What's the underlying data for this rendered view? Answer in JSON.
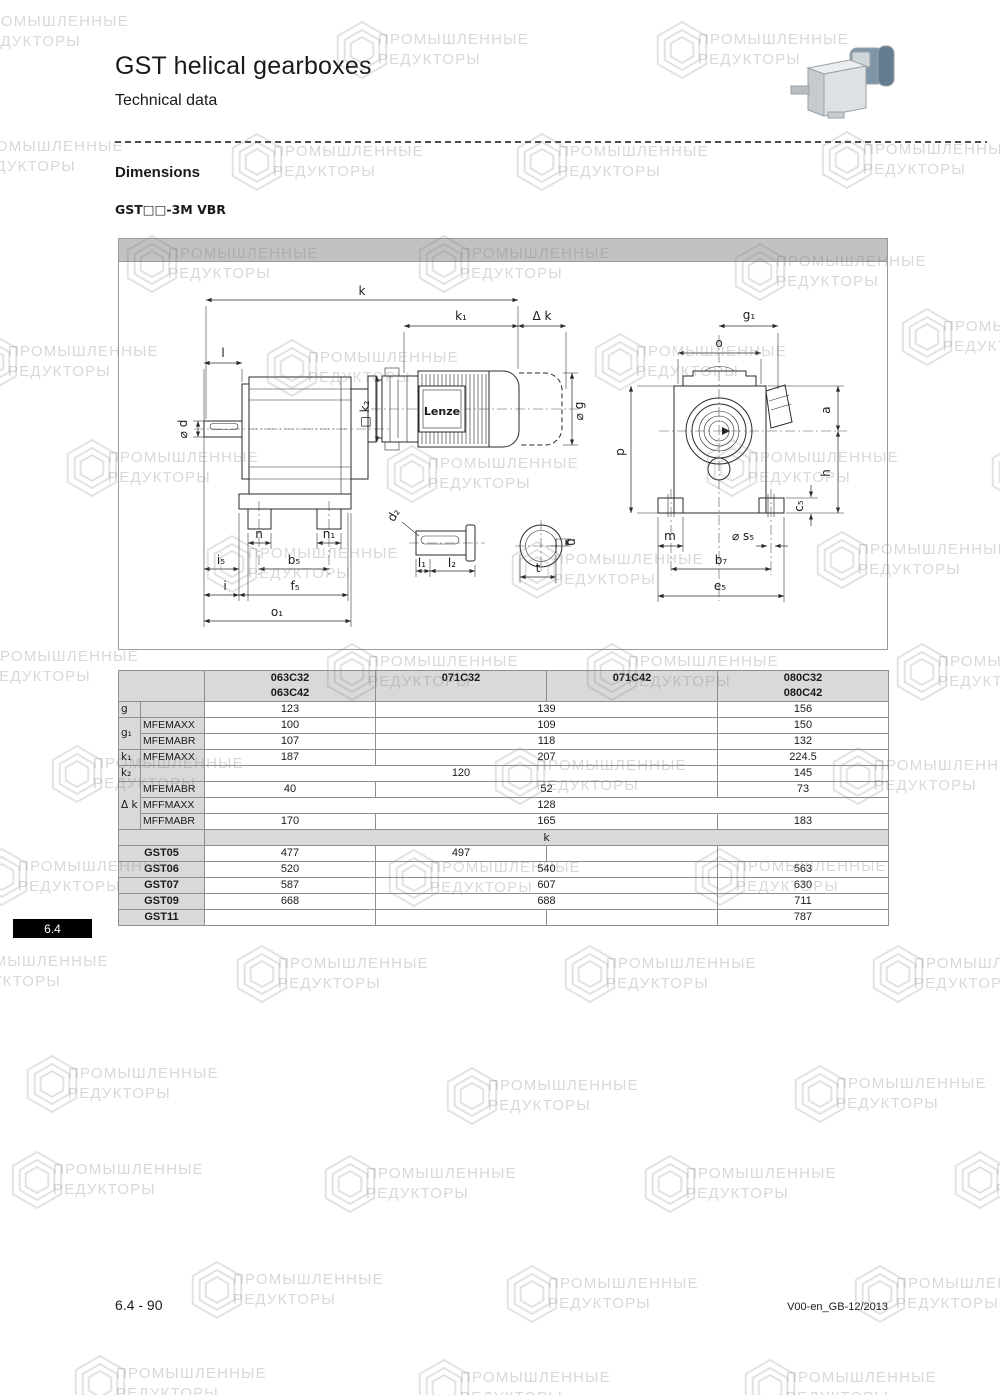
{
  "header": {
    "title": "GST helical gearboxes",
    "subtitle": "Technical data"
  },
  "section": {
    "heading": "Dimensions",
    "variant": "GST□□-3M VBR"
  },
  "footer": {
    "page": "6.4 - 90",
    "doc_code": "V00-en_GB-12/2013",
    "side_tab": "6.4"
  },
  "colors": {
    "table_header_bg": "#d9d9d9",
    "drawing_bar_bg": "#c2c2c2",
    "table_border": "#8f8f8f",
    "tab_bg": "#000000",
    "motor_blue": "#7f96a9"
  },
  "watermark": {
    "line1": "ПРОМЫШЛЕННЫЕ",
    "line2": "РЕДУКТОРЫ",
    "positions": [
      [
        -70,
        0
      ],
      [
        330,
        18
      ],
      [
        650,
        18
      ],
      [
        -75,
        125
      ],
      [
        225,
        130
      ],
      [
        510,
        130
      ],
      [
        815,
        128
      ],
      [
        120,
        232
      ],
      [
        412,
        232
      ],
      [
        728,
        240
      ],
      [
        -40,
        330
      ],
      [
        260,
        336
      ],
      [
        588,
        330
      ],
      [
        895,
        305
      ],
      [
        60,
        436
      ],
      [
        380,
        442
      ],
      [
        700,
        436
      ],
      [
        985,
        440
      ],
      [
        200,
        532
      ],
      [
        505,
        538
      ],
      [
        810,
        528
      ],
      [
        -60,
        635
      ],
      [
        320,
        640
      ],
      [
        580,
        640
      ],
      [
        890,
        640
      ],
      [
        45,
        742
      ],
      [
        488,
        744
      ],
      [
        826,
        744
      ],
      [
        -30,
        845
      ],
      [
        382,
        846
      ],
      [
        688,
        845
      ],
      [
        -90,
        940
      ],
      [
        230,
        942
      ],
      [
        558,
        942
      ],
      [
        866,
        942
      ],
      [
        20,
        1052
      ],
      [
        440,
        1064
      ],
      [
        788,
        1062
      ],
      [
        5,
        1148
      ],
      [
        318,
        1152
      ],
      [
        638,
        1152
      ],
      [
        948,
        1148
      ],
      [
        185,
        1258
      ],
      [
        500,
        1262
      ],
      [
        848,
        1262
      ],
      [
        68,
        1352
      ],
      [
        412,
        1356
      ],
      [
        738,
        1356
      ],
      [
        1000,
        1350
      ]
    ]
  },
  "drawing": {
    "logo": "Lenze",
    "labels": [
      {
        "t": "k",
        "x": 243,
        "y": 56
      },
      {
        "t": "k₁",
        "x": 342,
        "y": 81
      },
      {
        "t": "Δ k",
        "x": 423,
        "y": 81
      },
      {
        "t": "l",
        "x": 104,
        "y": 118
      },
      {
        "t": "⌀ d",
        "x": 68,
        "y": 190,
        "r": -90
      },
      {
        "t": "□ k₂",
        "x": 250,
        "y": 175,
        "r": -90
      },
      {
        "t": "⌀ g",
        "x": 464,
        "y": 172,
        "r": -90
      },
      {
        "t": "Lenze",
        "x": 323,
        "y": 176,
        "cls": "logo"
      },
      {
        "t": "n",
        "x": 140,
        "y": 299
      },
      {
        "t": "n₁",
        "x": 210,
        "y": 299
      },
      {
        "t": "i₅",
        "x": 102,
        "y": 325
      },
      {
        "t": "b₅",
        "x": 175,
        "y": 325
      },
      {
        "t": "i",
        "x": 106,
        "y": 351
      },
      {
        "t": "f₅",
        "x": 176,
        "y": 351
      },
      {
        "t": "o₁",
        "x": 158,
        "y": 377
      },
      {
        "t": "d₂",
        "x": 278,
        "y": 278,
        "r": -60
      },
      {
        "t": "l₁",
        "x": 303,
        "y": 328
      },
      {
        "t": "l₂",
        "x": 333,
        "y": 328
      },
      {
        "t": "u",
        "x": 456,
        "y": 303,
        "r": -90
      },
      {
        "t": "t",
        "x": 419,
        "y": 333
      },
      {
        "t": "g₁",
        "x": 630,
        "y": 80
      },
      {
        "t": "o",
        "x": 600,
        "y": 108
      },
      {
        "t": "a",
        "x": 711,
        "y": 171,
        "r": -90
      },
      {
        "t": "p",
        "x": 505,
        "y": 213,
        "r": -90
      },
      {
        "t": "h",
        "x": 711,
        "y": 234,
        "r": -90
      },
      {
        "t": "c₅",
        "x": 684,
        "y": 267,
        "r": -90
      },
      {
        "t": "m",
        "x": 551,
        "y": 301
      },
      {
        "t": "⌀ s₅",
        "x": 624,
        "y": 301
      },
      {
        "t": "b₇",
        "x": 602,
        "y": 325
      },
      {
        "t": "e₅",
        "x": 601,
        "y": 351
      }
    ]
  },
  "table": {
    "col_headers": [
      [
        "063C32",
        "063C42"
      ],
      [
        "071C32"
      ],
      [
        "071C42"
      ],
      [
        "080C32",
        "080C42"
      ]
    ],
    "dim_rows": [
      {
        "label": "g",
        "label_rowspan": 1,
        "sub": "",
        "cells": [
          [
            "123",
            1
          ],
          [
            "139",
            2
          ],
          [
            "156",
            1
          ]
        ]
      },
      {
        "label": "g₁",
        "label_rowspan": 2,
        "sub": "MFEMAXX",
        "cells": [
          [
            "100",
            1
          ],
          [
            "109",
            2
          ],
          [
            "150",
            1
          ]
        ]
      },
      {
        "sub": "MFEMABR",
        "cells": [
          [
            "107",
            1
          ],
          [
            "118",
            2
          ],
          [
            "132",
            1
          ]
        ]
      },
      {
        "label": "k₁",
        "label_rowspan": 1,
        "sub": "MFEMAXX",
        "cells": [
          [
            "187",
            1
          ],
          [
            "207",
            2
          ],
          [
            "224.5",
            1
          ]
        ]
      },
      {
        "label": "k₂",
        "label_rowspan": 1,
        "sub": "",
        "cells": [
          [
            "120",
            3
          ],
          [
            "145",
            1
          ]
        ]
      },
      {
        "label": "Δ k",
        "label_rowspan": 3,
        "sub": "MFEMABR",
        "cells": [
          [
            "40",
            1
          ],
          [
            "52",
            2
          ],
          [
            "73",
            1
          ]
        ]
      },
      {
        "sub": "MFFMAXX",
        "cells": [
          [
            "128",
            4
          ]
        ]
      },
      {
        "sub": "MFFMABR",
        "cells": [
          [
            "170",
            1
          ],
          [
            "165",
            2
          ],
          [
            "183",
            1
          ]
        ]
      }
    ],
    "k_section_label": "k",
    "gst_rows": [
      {
        "label": "GST05",
        "cells": [
          [
            "477",
            1
          ],
          [
            "497",
            1
          ],
          [
            "",
            1
          ],
          [
            "",
            1
          ]
        ]
      },
      {
        "label": "GST06",
        "cells": [
          [
            "520",
            1
          ],
          [
            "540",
            2
          ],
          [
            "563",
            1
          ]
        ]
      },
      {
        "label": "GST07",
        "cells": [
          [
            "587",
            1
          ],
          [
            "607",
            2
          ],
          [
            "630",
            1
          ]
        ]
      },
      {
        "label": "GST09",
        "cells": [
          [
            "668",
            1
          ],
          [
            "688",
            2
          ],
          [
            "711",
            1
          ]
        ]
      },
      {
        "label": "GST11",
        "cells": [
          [
            "",
            1
          ],
          [
            "",
            1
          ],
          [
            "",
            1
          ],
          [
            "787",
            1
          ]
        ]
      }
    ]
  }
}
